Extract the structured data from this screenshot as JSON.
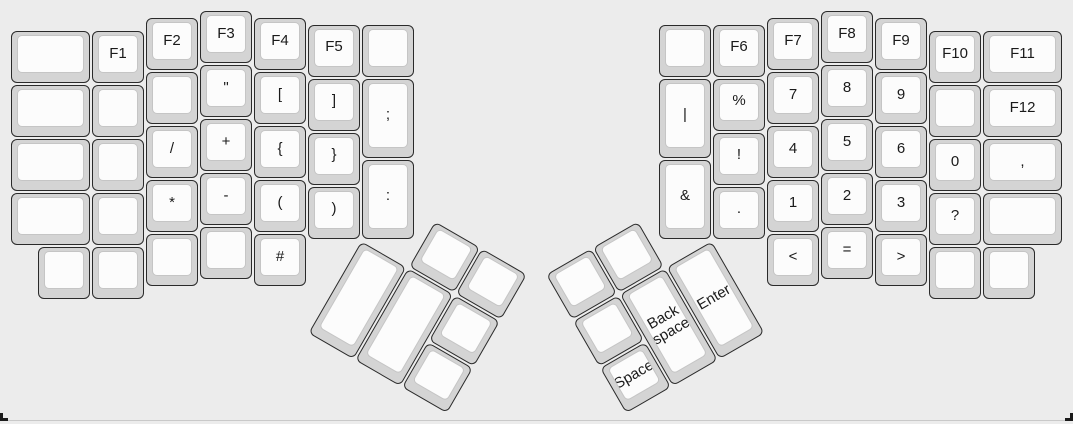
{
  "canvas": {
    "background": "#ececec",
    "bottom_edge_color": "#c9c9c9",
    "corner_mark_color": "#1b1b1b"
  },
  "keycap": {
    "base_color": "#d4d4d4",
    "top_color": "#fcfcfc",
    "border_color": "#2a2a2a",
    "legend_color": "#1a1a1a"
  },
  "layout": {
    "unit": 54,
    "origin_x": 10,
    "origin_y": 10
  },
  "groups": [
    {
      "name": "left-main",
      "origin_x": 10,
      "origin_y": 10,
      "rotation_deg": 0,
      "keys": [
        {
          "name": "blank",
          "label": "",
          "x": 0,
          "y": 0.375,
          "w": 1.5,
          "h": 1
        },
        {
          "name": "blank",
          "label": "",
          "x": 0,
          "y": 1.375,
          "w": 1.5,
          "h": 1
        },
        {
          "name": "blank",
          "label": "",
          "x": 0,
          "y": 2.375,
          "w": 1.5,
          "h": 1
        },
        {
          "name": "blank",
          "label": "",
          "x": 0,
          "y": 3.375,
          "w": 1.5,
          "h": 1
        },
        {
          "name": "f1",
          "label": "F1",
          "x": 1.5,
          "y": 0.375,
          "w": 1,
          "h": 1
        },
        {
          "name": "blank",
          "label": "",
          "x": 1.5,
          "y": 1.375,
          "w": 1,
          "h": 1
        },
        {
          "name": "blank",
          "label": "",
          "x": 1.5,
          "y": 2.375,
          "w": 1,
          "h": 1
        },
        {
          "name": "blank",
          "label": "",
          "x": 1.5,
          "y": 3.375,
          "w": 1,
          "h": 1
        },
        {
          "name": "f2",
          "label": "F2",
          "x": 2.5,
          "y": 0.125,
          "w": 1,
          "h": 1
        },
        {
          "name": "blank",
          "label": "",
          "x": 2.5,
          "y": 1.125,
          "w": 1,
          "h": 1
        },
        {
          "name": "slash",
          "label": "/",
          "x": 2.5,
          "y": 2.125,
          "w": 1,
          "h": 1
        },
        {
          "name": "asterisk",
          "label": "*",
          "x": 2.5,
          "y": 3.125,
          "w": 1,
          "h": 1
        },
        {
          "name": "blank",
          "label": "",
          "x": 2.5,
          "y": 4.125,
          "w": 1,
          "h": 1
        },
        {
          "name": "f3",
          "label": "F3",
          "x": 3.5,
          "y": 0,
          "w": 1,
          "h": 1
        },
        {
          "name": "double-quote",
          "label": "\"",
          "x": 3.5,
          "y": 1,
          "w": 1,
          "h": 1
        },
        {
          "name": "plus",
          "label": "+",
          "x": 3.5,
          "y": 2,
          "w": 1,
          "h": 1
        },
        {
          "name": "minus",
          "label": "-",
          "x": 3.5,
          "y": 3,
          "w": 1,
          "h": 1
        },
        {
          "name": "blank",
          "label": "",
          "x": 3.5,
          "y": 4,
          "w": 1,
          "h": 1
        },
        {
          "name": "f4",
          "label": "F4",
          "x": 4.5,
          "y": 0.125,
          "w": 1,
          "h": 1
        },
        {
          "name": "left-bracket",
          "label": "[",
          "x": 4.5,
          "y": 1.125,
          "w": 1,
          "h": 1
        },
        {
          "name": "left-brace",
          "label": "{",
          "x": 4.5,
          "y": 2.125,
          "w": 1,
          "h": 1
        },
        {
          "name": "left-paren",
          "label": "(",
          "x": 4.5,
          "y": 3.125,
          "w": 1,
          "h": 1
        },
        {
          "name": "hash",
          "label": "#",
          "x": 4.5,
          "y": 4.125,
          "w": 1,
          "h": 1
        },
        {
          "name": "f5",
          "label": "F5",
          "x": 5.5,
          "y": 0.25,
          "w": 1,
          "h": 1
        },
        {
          "name": "right-bracket",
          "label": "]",
          "x": 5.5,
          "y": 1.25,
          "w": 1,
          "h": 1
        },
        {
          "name": "right-brace",
          "label": "}",
          "x": 5.5,
          "y": 2.25,
          "w": 1,
          "h": 1
        },
        {
          "name": "right-paren",
          "label": ")",
          "x": 5.5,
          "y": 3.25,
          "w": 1,
          "h": 1
        },
        {
          "name": "blank",
          "label": "",
          "x": 6.5,
          "y": 0.25,
          "w": 1,
          "h": 1
        },
        {
          "name": "semicolon",
          "label": ";",
          "x": 6.5,
          "y": 1.25,
          "w": 1,
          "h": 1.5
        },
        {
          "name": "colon",
          "label": ":",
          "x": 6.5,
          "y": 2.75,
          "w": 1,
          "h": 1.5
        },
        {
          "name": "blank",
          "label": "",
          "x": 0.5,
          "y": 4.375,
          "w": 1,
          "h": 1
        },
        {
          "name": "blank",
          "label": "",
          "x": 1.5,
          "y": 4.375,
          "w": 1,
          "h": 1
        }
      ]
    },
    {
      "name": "right-main",
      "origin_x": 10,
      "origin_y": 10,
      "rotation_deg": 0,
      "keys": [
        {
          "name": "blank",
          "label": "",
          "x": 12,
          "y": 0.25,
          "w": 1,
          "h": 1
        },
        {
          "name": "pipe",
          "label": "|",
          "x": 12,
          "y": 1.25,
          "w": 1,
          "h": 1.5
        },
        {
          "name": "ampersand",
          "label": "&",
          "x": 12,
          "y": 2.75,
          "w": 1,
          "h": 1.5
        },
        {
          "name": "f6",
          "label": "F6",
          "x": 13,
          "y": 0.25,
          "w": 1,
          "h": 1
        },
        {
          "name": "percent",
          "label": "%",
          "x": 13,
          "y": 1.25,
          "w": 1,
          "h": 1
        },
        {
          "name": "exclamation",
          "label": "!",
          "x": 13,
          "y": 2.25,
          "w": 1,
          "h": 1
        },
        {
          "name": "period",
          "label": ".",
          "x": 13,
          "y": 3.25,
          "w": 1,
          "h": 1
        },
        {
          "name": "f7",
          "label": "F7",
          "x": 14,
          "y": 0.125,
          "w": 1,
          "h": 1
        },
        {
          "name": "digit-7",
          "label": "7",
          "x": 14,
          "y": 1.125,
          "w": 1,
          "h": 1
        },
        {
          "name": "digit-4",
          "label": "4",
          "x": 14,
          "y": 2.125,
          "w": 1,
          "h": 1
        },
        {
          "name": "digit-1",
          "label": "1",
          "x": 14,
          "y": 3.125,
          "w": 1,
          "h": 1
        },
        {
          "name": "less-than",
          "label": "<",
          "x": 14,
          "y": 4.125,
          "w": 1,
          "h": 1
        },
        {
          "name": "f8",
          "label": "F8",
          "x": 15,
          "y": 0,
          "w": 1,
          "h": 1
        },
        {
          "name": "digit-8",
          "label": "8",
          "x": 15,
          "y": 1,
          "w": 1,
          "h": 1
        },
        {
          "name": "digit-5",
          "label": "5",
          "x": 15,
          "y": 2,
          "w": 1,
          "h": 1
        },
        {
          "name": "digit-2",
          "label": "2",
          "x": 15,
          "y": 3,
          "w": 1,
          "h": 1
        },
        {
          "name": "equals",
          "label": "=",
          "x": 15,
          "y": 4,
          "w": 1,
          "h": 1
        },
        {
          "name": "f9",
          "label": "F9",
          "x": 16,
          "y": 0.125,
          "w": 1,
          "h": 1
        },
        {
          "name": "digit-9",
          "label": "9",
          "x": 16,
          "y": 1.125,
          "w": 1,
          "h": 1
        },
        {
          "name": "digit-6",
          "label": "6",
          "x": 16,
          "y": 2.125,
          "w": 1,
          "h": 1
        },
        {
          "name": "digit-3",
          "label": "3",
          "x": 16,
          "y": 3.125,
          "w": 1,
          "h": 1
        },
        {
          "name": "greater-than",
          "label": ">",
          "x": 16,
          "y": 4.125,
          "w": 1,
          "h": 1
        },
        {
          "name": "f10",
          "label": "F10",
          "x": 17,
          "y": 0.375,
          "w": 1,
          "h": 1
        },
        {
          "name": "blank",
          "label": "",
          "x": 17,
          "y": 1.375,
          "w": 1,
          "h": 1
        },
        {
          "name": "digit-0",
          "label": "0",
          "x": 17,
          "y": 2.375,
          "w": 1,
          "h": 1
        },
        {
          "name": "question",
          "label": "?",
          "x": 17,
          "y": 3.375,
          "w": 1,
          "h": 1
        },
        {
          "name": "blank",
          "label": "",
          "x": 17,
          "y": 4.375,
          "w": 1,
          "h": 1
        },
        {
          "name": "f11",
          "label": "F11",
          "x": 18,
          "y": 0.375,
          "w": 1.5,
          "h": 1
        },
        {
          "name": "f12",
          "label": "F12",
          "x": 18,
          "y": 1.375,
          "w": 1.5,
          "h": 1
        },
        {
          "name": "comma",
          "label": ",",
          "x": 18,
          "y": 2.375,
          "w": 1.5,
          "h": 1
        },
        {
          "name": "blank",
          "label": "",
          "x": 18,
          "y": 3.375,
          "w": 1.5,
          "h": 1
        },
        {
          "name": "blank",
          "label": "",
          "x": 18,
          "y": 4.375,
          "w": 1,
          "h": 1
        }
      ]
    },
    {
      "name": "left-thumb-cluster",
      "origin_x": 361,
      "origin_y": 239.5,
      "rotation_deg": 30,
      "keys": [
        {
          "name": "blank",
          "label": "",
          "x": 1,
          "y": -1,
          "w": 1,
          "h": 1
        },
        {
          "name": "blank",
          "label": "",
          "x": 2,
          "y": -1,
          "w": 1,
          "h": 1
        },
        {
          "name": "blank",
          "label": "",
          "x": 0,
          "y": 0,
          "w": 1,
          "h": 2
        },
        {
          "name": "blank",
          "label": "",
          "x": 1,
          "y": 0,
          "w": 1,
          "h": 2
        },
        {
          "name": "blank",
          "label": "",
          "x": 2,
          "y": 0,
          "w": 1,
          "h": 1
        },
        {
          "name": "blank",
          "label": "",
          "x": 2,
          "y": 1,
          "w": 1,
          "h": 1
        }
      ]
    },
    {
      "name": "right-thumb-cluster",
      "origin_x": 712,
      "origin_y": 239.5,
      "rotation_deg": -30,
      "keys": [
        {
          "name": "blank",
          "label": "",
          "x": -3,
          "y": -1,
          "w": 1,
          "h": 1
        },
        {
          "name": "blank",
          "label": "",
          "x": -2,
          "y": -1,
          "w": 1,
          "h": 1
        },
        {
          "name": "blank",
          "label": "",
          "x": -3,
          "y": 0,
          "w": 1,
          "h": 1
        },
        {
          "name": "backspace",
          "label": "Back space",
          "x": -2,
          "y": 0,
          "w": 1,
          "h": 2
        },
        {
          "name": "enter",
          "label": "Enter",
          "x": -1,
          "y": 0,
          "w": 1,
          "h": 2
        },
        {
          "name": "space",
          "label": "Space",
          "x": -3,
          "y": 1,
          "w": 1,
          "h": 1
        }
      ]
    }
  ]
}
